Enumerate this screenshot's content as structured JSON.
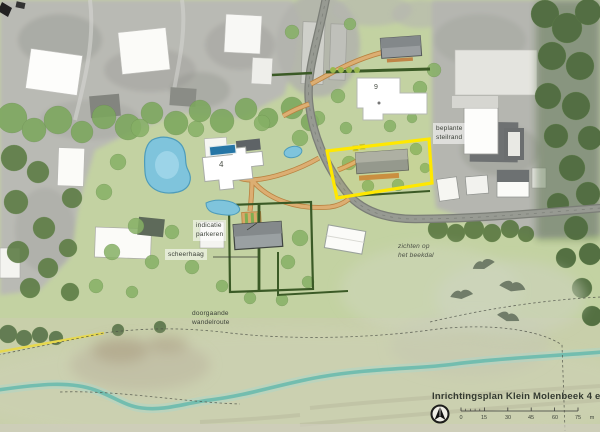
{
  "title_block": {
    "title": "Inrichtingsplan Klein Molenbeek 4 en 9",
    "scalebar": {
      "tick_labels": [
        "0",
        "15",
        "30",
        "45",
        "60",
        "75"
      ],
      "unit_label": "m"
    }
  },
  "map_labels": {
    "parcel_4_number": "4",
    "parcel_9_number": "9",
    "parking_line1": "indicatie",
    "parking_line2": "parkeren",
    "hedge": "scheerhaag",
    "route_line1": "doorgaande",
    "route_line2": "wandelroute",
    "views_line1": "zichten op",
    "views_line2": "het beekdal",
    "slope_line1": "beplante",
    "slope_line2": "steilrand"
  },
  "icons": {
    "north_arrow": "north-arrow-icon"
  },
  "colors": {
    "parcel_highlight": "#ffe800",
    "water": "#7fc4dc",
    "stream": "#6fbcae",
    "path_orange": "#dcae72",
    "hedge_green": "#3b5a26",
    "road_gray": "#8f928e"
  }
}
